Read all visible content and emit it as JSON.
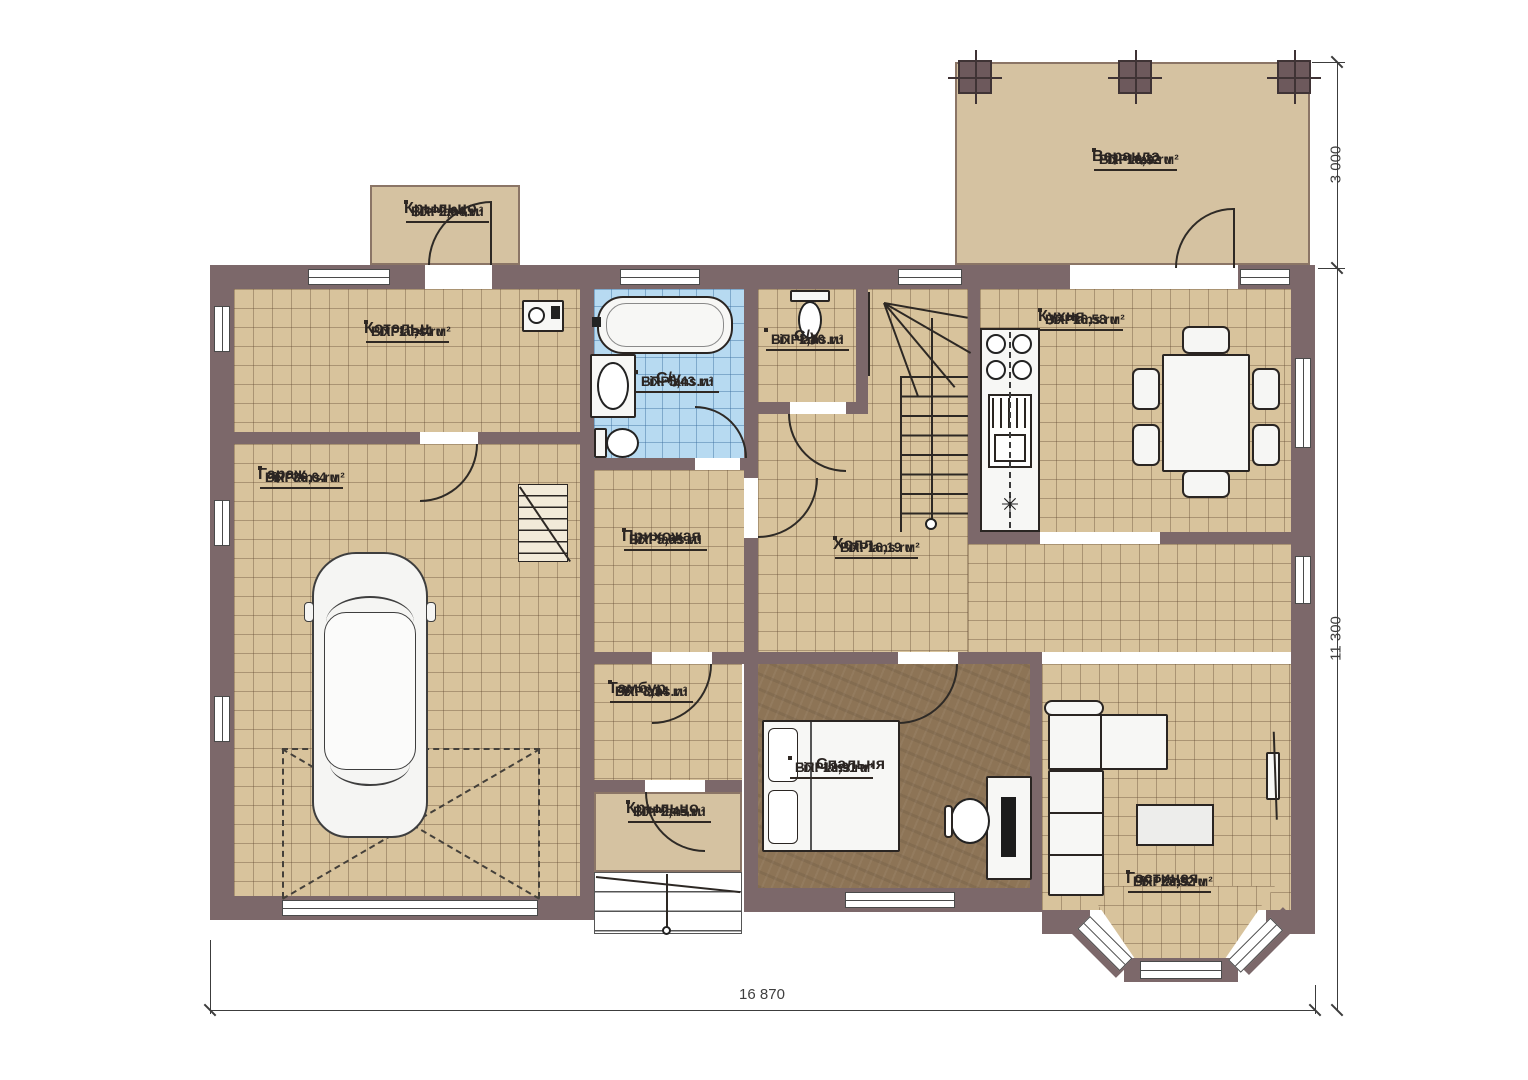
{
  "rooms": {
    "veranda": {
      "name": "Веранда",
      "watermark": "FixPlans.ru",
      "area": "ВП: 16,32 м²"
    },
    "porch_top": {
      "name": "Крыльцо",
      "watermark": "FixPlans.ru",
      "area": "ВП: 2,64 м²"
    },
    "boiler": {
      "name": "Котельн.",
      "watermark": "FixPlans.ru",
      "area": "ВП: 10,44 м²"
    },
    "bathroom_main": {
      "name": "С/у",
      "watermark": "FixPlans.ru",
      "area": "ВП: 5,43 м²"
    },
    "bathroom_small": {
      "name": "С/у",
      "watermark": "FixPlans.ru",
      "area": "ВП: 1,80 м²"
    },
    "kitchen": {
      "name": "Кухня",
      "watermark": "FixPlans.ru",
      "area": "ВП: 16,58 м²"
    },
    "garage": {
      "name": "Гараж",
      "watermark": "FixPlans.ru",
      "area": "ВП: 36,04 м²"
    },
    "hallway": {
      "name": "Прихожая",
      "watermark": "FixPlans.ru",
      "area": "ВП: 5,69 м²"
    },
    "hall": {
      "name": "Холл",
      "watermark": "FixPlans.ru",
      "area": "ВП: 16,19 м²"
    },
    "vestibule": {
      "name": "Тамбур",
      "watermark": "FixPlans.ru",
      "area": "ВП: 3,34 м²"
    },
    "porch_bottom": {
      "name": "Крыльцо",
      "watermark": "FixPlans.ru",
      "area": "ВП: 2,45 м²"
    },
    "bedroom": {
      "name": "Спальня",
      "watermark": "FixPlans.ru",
      "area": "ВП: 13,91 м²"
    },
    "living": {
      "name": "Гостиная",
      "watermark": "FixPlans.ru",
      "area": "ВП: 23,32 м²"
    }
  },
  "dimensions": {
    "bottom": "16 870",
    "right": "11 300",
    "top_right": "3 000"
  },
  "symbols": {
    "fridge": "✳"
  },
  "colors": {
    "wall": "#7c686a",
    "floor_tile": "#d8c39c",
    "bathroom_tile": "#b7daf1",
    "wood_floor": "#8d7456",
    "outdoor": "#d5c2a1"
  }
}
